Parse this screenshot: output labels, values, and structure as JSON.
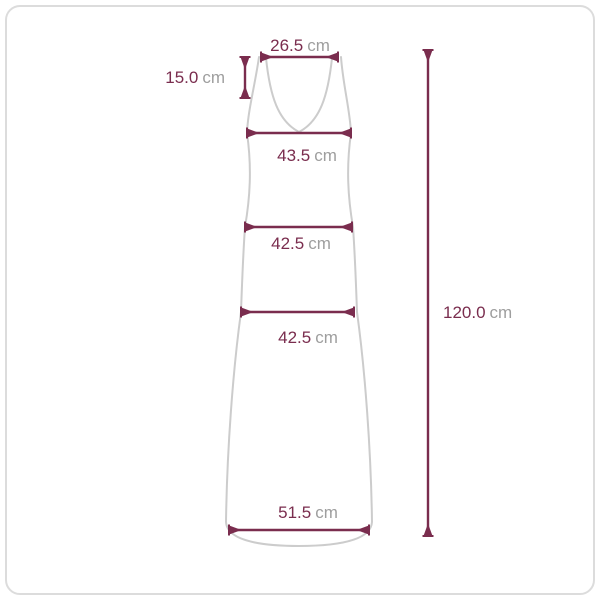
{
  "diagram": {
    "unit": "cm",
    "colors": {
      "measurement_accent": "#7a2d4e",
      "unit_text": "#9e9e9e",
      "garment_outline": "#cccccc",
      "frame_border": "#dcdcdc",
      "background": "#ffffff"
    },
    "measurements": {
      "top_width": {
        "value": "26.5",
        "unit": "cm"
      },
      "strap_length": {
        "value": "15.0",
        "unit": "cm"
      },
      "bust_width": {
        "value": "43.5",
        "unit": "cm"
      },
      "waist_width": {
        "value": "42.5",
        "unit": "cm"
      },
      "hip_width": {
        "value": "42.5",
        "unit": "cm"
      },
      "hem_width": {
        "value": "51.5",
        "unit": "cm"
      },
      "total_length": {
        "value": "120.0",
        "unit": "cm"
      }
    }
  }
}
